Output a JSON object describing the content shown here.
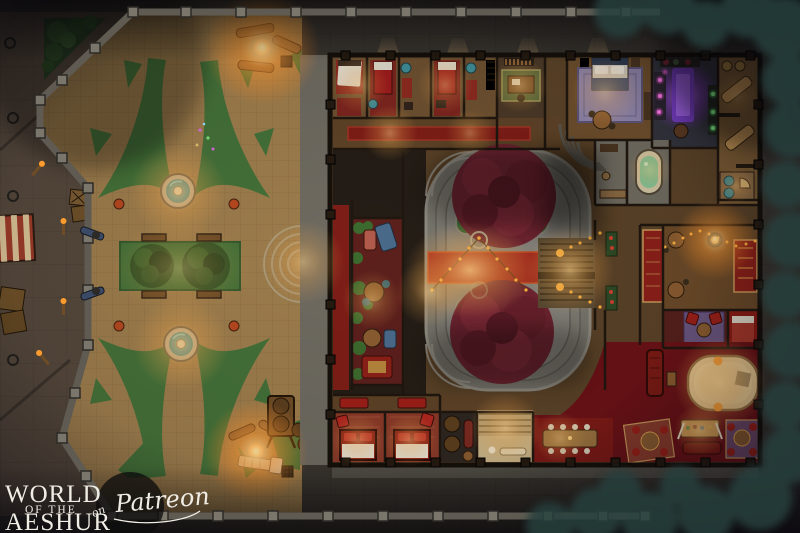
{
  "logo": {
    "line1": "WORLD",
    "line2": "OF THE",
    "line3": "AESHUR",
    "script_prefix": "on",
    "script_name": "Patreon"
  },
  "palette": {
    "street": "#38332d",
    "plaza_sand": "#a5854f",
    "grass_green": "#447038",
    "wall_stone": "#6e6a60",
    "wood_floor": "#6b4c2c",
    "carpet_red": "#8e241c",
    "water_teal": "#2e7f8a",
    "crimson_tree": "#7c2936",
    "warm_glow": "#ffbe69",
    "arcane_purple": "#a14de0",
    "runway_cream": "#ecd4a0",
    "night_foliage": "#26403c"
  },
  "map": {
    "kind": "top-down fantasy battlemap",
    "features": [
      "city wall with posts",
      "market street",
      "plaza",
      "fountains",
      "lawn with trees",
      "campfires",
      "guest bedrooms",
      "office",
      "grand bedroom",
      "alchemy room",
      "spa room",
      "bathhouse",
      "central courtyard",
      "crimson canopy trees",
      "red carpet",
      "string lights",
      "grand staircase",
      "fire-lit lounge",
      "stage runway",
      "dining table"
    ]
  }
}
